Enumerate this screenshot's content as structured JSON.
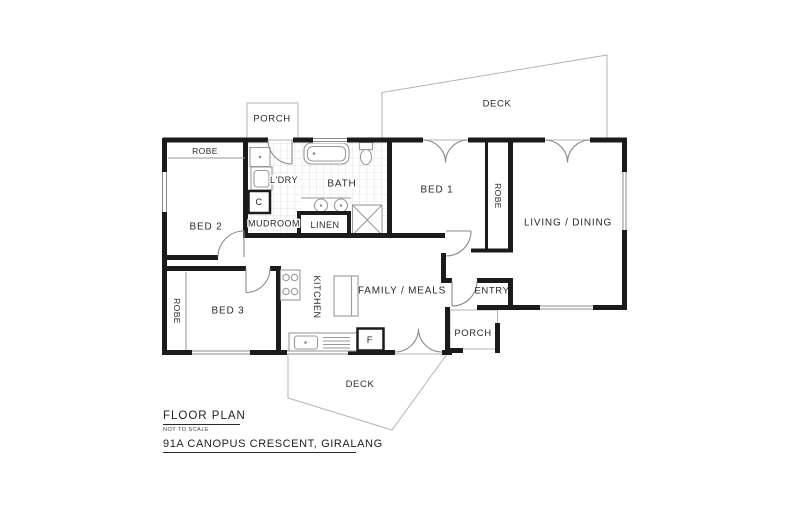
{
  "title_block": {
    "heading": "FLOOR PLAN",
    "scale_note": "NOT TO SCALE",
    "address": "91A CANOPUS CRESCENT, GIRALANG"
  },
  "rooms": {
    "bed1": "BED 1",
    "bed2": "BED 2",
    "bed3": "BED 3",
    "living_dining": "LIVING / DINING",
    "family_meals": "FAMILY / MEALS",
    "kitchen": "KITCHEN",
    "bath": "BATH",
    "laundry": "L'DRY",
    "linen": "LINEN",
    "mudroom": "MUDROOM",
    "entry": "ENTRY"
  },
  "outdoor": {
    "deck_top": "DECK",
    "deck_bottom": "DECK",
    "porch_top": "PORCH",
    "porch_front": "PORCH"
  },
  "fitments": {
    "robe_bed1": "ROBE",
    "robe_bed2": "ROBE",
    "robe_bed3": "ROBE",
    "cupboard": "C",
    "fridge": "F"
  },
  "colors": {
    "wall": "#1b1b1b",
    "fixture_line": "#9a9a9a",
    "door_line": "#8a8a8a",
    "tile_grid": "#d9d9d9",
    "outdoor_outline": "#b5b5b5",
    "label_text": "#2a2a2a",
    "background": "#ffffff"
  }
}
